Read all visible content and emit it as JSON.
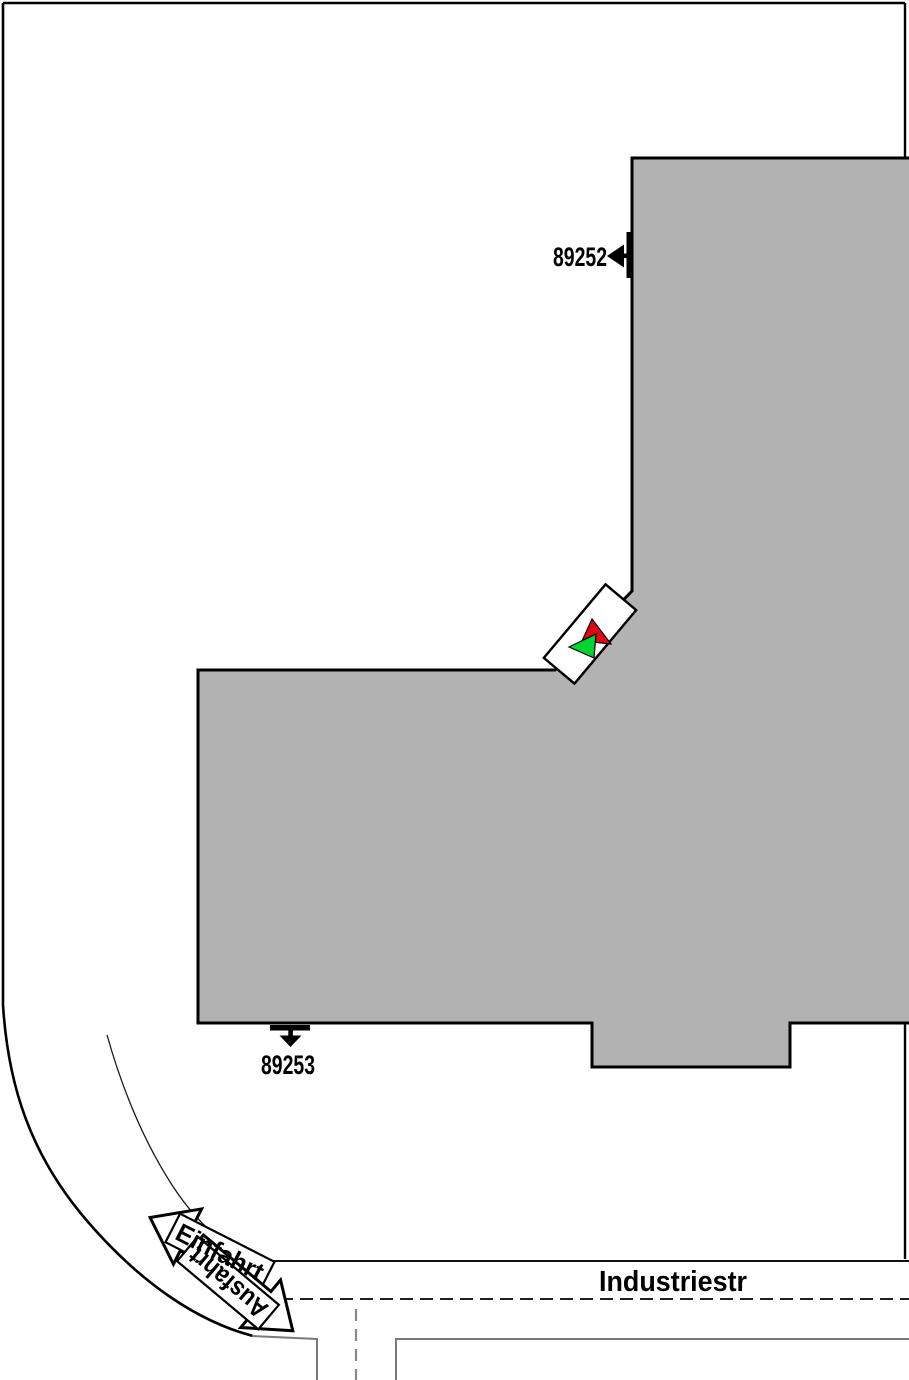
{
  "plan": {
    "street_label": "Industriestr",
    "entrance_arrow_label": "Einfahrt",
    "exit_arrow_label": "Ausfahrt",
    "upper_door_id": "89252",
    "lower_door_id": "89253"
  },
  "colors": {
    "building_fill": "#b2b2b2",
    "outline": "#000000",
    "road_edge_gray": "#7a7a7a",
    "gate_green": "#00d42e",
    "gate_red": "#e20613",
    "arrow_fill": "#ffffff"
  }
}
